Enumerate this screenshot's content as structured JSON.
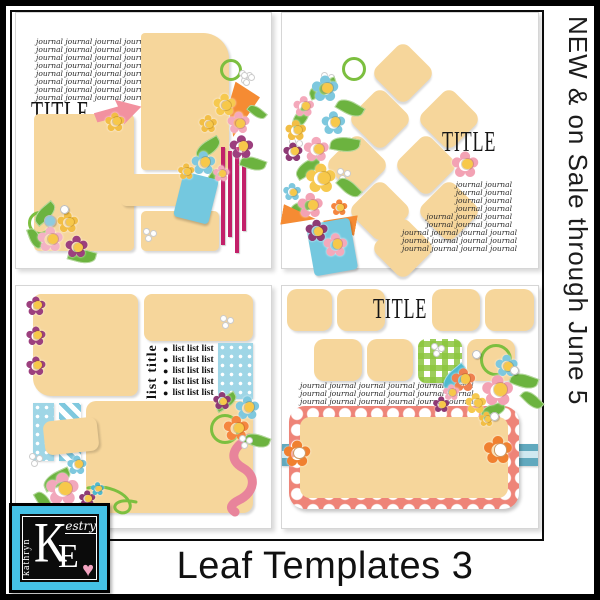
{
  "side_banner": {
    "text": "NEW & on Sale through June 5"
  },
  "footer": {
    "title": "Leaf Templates 3"
  },
  "logo": {
    "vertical_name": "kathryn",
    "initial_k": "K",
    "name_suffix": "estry",
    "initial_e": "E",
    "heart": "♥"
  },
  "icons": {
    "flower": "✿"
  },
  "templates": {
    "t1": {
      "title": "TITLE",
      "journal_lines": [
        "journal journal journal journal",
        "journal journal journal journal",
        "journal journal journal journal",
        "journal journal journal journal",
        "journal journal journal journal",
        "journal journal journal journal",
        "journal journal journal journal",
        "journal journal journal journal"
      ]
    },
    "t2": {
      "title": "TITLE",
      "journal_lines": [
        "journal journal",
        "journal journal",
        "journal journal",
        "journal journal",
        "journal journal journal",
        "journal journal journal",
        "journal journal journal journal",
        "journal journal journal journal",
        "journal journal journal journal"
      ]
    },
    "t3": {
      "list_title": "list title",
      "bullet": "●",
      "list_items": [
        "list list list",
        "list list list",
        "list list list",
        "list list list",
        "list list list"
      ]
    },
    "t4": {
      "title": "TITLE",
      "journal_lines": [
        "journal journal journal journal journal journal",
        "journal journal journal journal journal journal",
        "journal journal journal journal journal journal"
      ]
    }
  },
  "colors": {
    "placeholder_tan": "#F6D69B",
    "magenta_ribbon": "#C22069",
    "pink_arrow": "#F2919F",
    "teal_tag": "#74C8DF",
    "teal_polka": "#9FD6E6",
    "gingham_green": "#8CC63E",
    "polka_frame_red": "#EE8478",
    "ribbon_teal": "#61A9BE",
    "orange_flower": "#F08030",
    "pink_flower": "#F4A9BB",
    "purple_flower": "#9C3F7E",
    "blue_flower": "#7EC8DE",
    "yellow_flower": "#F2BE45",
    "leaf_green": "#6CB33F",
    "logo_teal": "#45C1E6",
    "heart_pink": "#F2A3C0"
  }
}
